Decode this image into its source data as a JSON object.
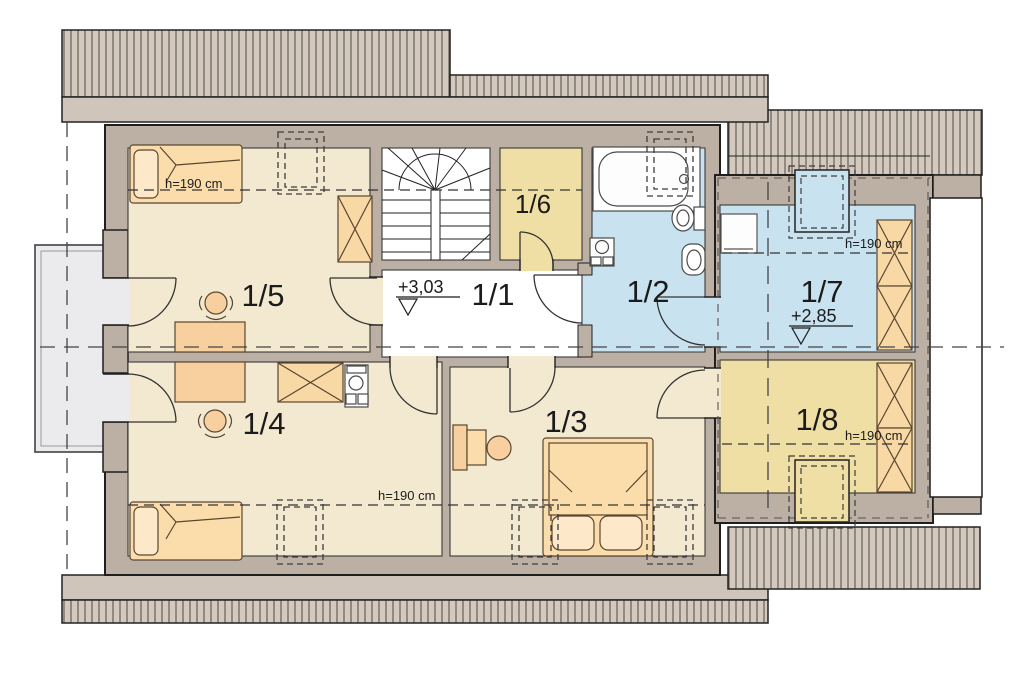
{
  "rooms": {
    "r11": "1/1",
    "r12": "1/2",
    "r13": "1/3",
    "r14": "1/4",
    "r15": "1/5",
    "r16": "1/6",
    "r17": "1/7",
    "r18": "1/8"
  },
  "levels": {
    "main": "+3,03",
    "annex": "+2,85"
  },
  "headroom": "h=190 cm",
  "colors": {
    "wall": "#bcafa3",
    "roof_hatch_bg": "#d3c9be",
    "roof_hatch_line": "#776e64",
    "eave": "#cfc5ba",
    "room_cream": "#f2e9d0",
    "room_yellow": "#f0dfa4",
    "room_blue": "#c8e3ef",
    "furniture_peach": "#fbdcab",
    "furniture_dark_peach": "#f8d0a0",
    "balcony_gray": "#ebebed",
    "hall_white": "#ffffff"
  }
}
